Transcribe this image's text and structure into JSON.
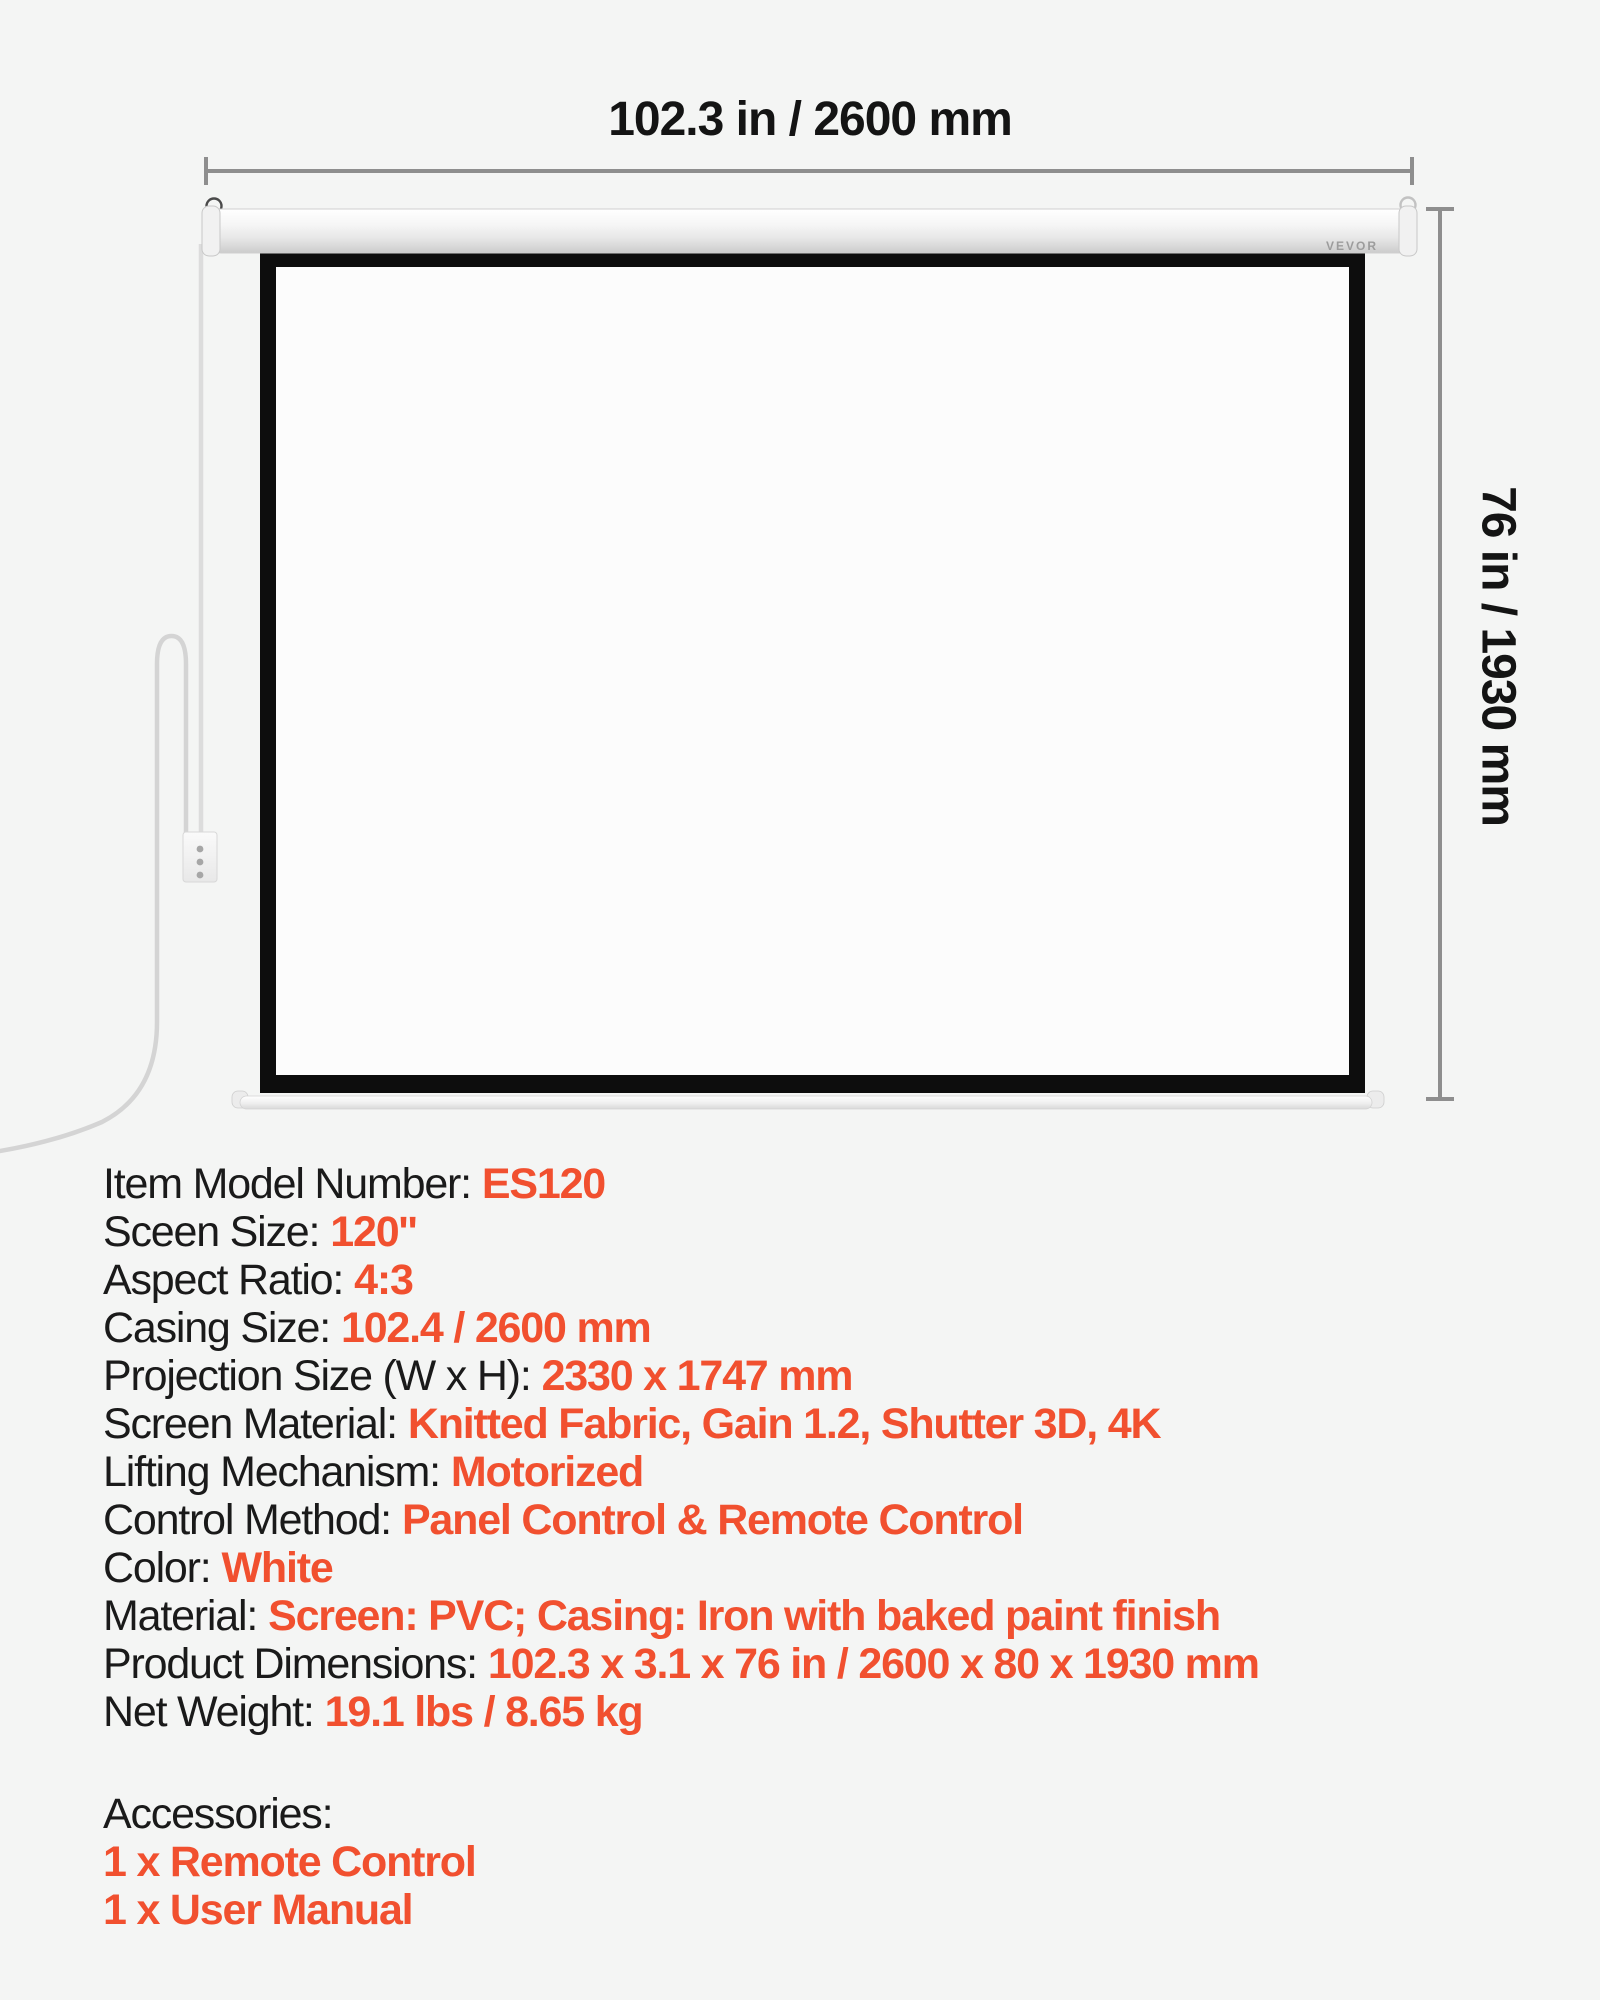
{
  "diagram": {
    "width_label": "102.3 in / 2600 mm",
    "height_label": "76 in / 1930 mm",
    "brand_logo": "VEVOR"
  },
  "specs": {
    "rows": [
      {
        "label": "Item Model Number:",
        "value": "ES120"
      },
      {
        "label": "Sceen Size:",
        "value": "120''"
      },
      {
        "label": "Aspect Ratio:",
        "value": "4:3"
      },
      {
        "label": "Casing Size:",
        "value": "102.4 / 2600 mm"
      },
      {
        "label": "Projection Size (W x H):",
        "value": "2330 x 1747 mm"
      },
      {
        "label": "Screen Material:",
        "value": "Knitted Fabric, Gain 1.2, Shutter 3D, 4K"
      },
      {
        "label": "Lifting Mechanism:",
        "value": "Motorized"
      },
      {
        "label": "Control Method:",
        "value": "Panel Control & Remote Control"
      },
      {
        "label": "Color:",
        "value": "White"
      },
      {
        "label": "Material:",
        "value": "Screen: PVC; Casing: Iron with baked paint finish"
      },
      {
        "label": "Product Dimensions:",
        "value": "102.3 x 3.1 x 76 in / 2600 x 80 x 1930 mm"
      },
      {
        "label": "Net Weight:",
        "value": "19.1 lbs / 8.65 kg"
      }
    ],
    "accessories": {
      "header": "Accessories:",
      "items": [
        "1 x Remote Control",
        "1 x User Manual"
      ]
    }
  },
  "colors": {
    "accent_orange": "#F1502F",
    "text_black": "#1A1A1A",
    "dimension_gray": "#8E8E8E",
    "screen_border_black": "#0D0D0D",
    "background": "#F4F5F4",
    "cord_gray": "#D6D6D6"
  }
}
